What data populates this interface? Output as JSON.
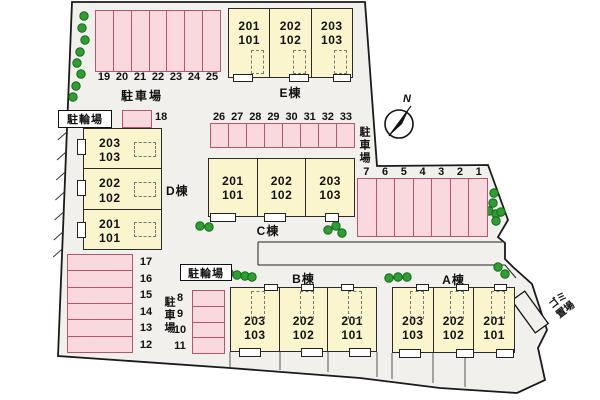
{
  "labels": {
    "parking_lot": "駐車場",
    "bicycle_parking": "駐輪場",
    "garbage": {
      "line1": "ゴミ",
      "line2": "置場"
    }
  },
  "compass": {
    "label": "N"
  },
  "parking": {
    "top_left": {
      "label": "駐車場",
      "spaces": [
        "19",
        "20",
        "21",
        "22",
        "23",
        "24",
        "25"
      ]
    },
    "middle": {
      "label": "駐車場",
      "spaces": [
        "26",
        "27",
        "28",
        "29",
        "30",
        "31",
        "32",
        "33"
      ]
    },
    "right": {
      "spaces": [
        "7",
        "6",
        "5",
        "4",
        "3",
        "2",
        "1"
      ]
    },
    "bottom_left": {
      "label": "駐車場",
      "spaces": [
        "17",
        "16",
        "15",
        "14",
        "13",
        "12"
      ]
    },
    "space_18": {
      "number": "18"
    },
    "bicycle_1": {
      "label": "駐輪場"
    },
    "bicycle_2": {
      "label": "駐輪場",
      "spaces": [
        "8",
        "9",
        "10",
        "11"
      ]
    }
  },
  "buildings": {
    "e": {
      "name": "E棟",
      "units": [
        {
          "upper": "201",
          "lower": "101"
        },
        {
          "upper": "202",
          "lower": "102"
        },
        {
          "upper": "203",
          "lower": "103"
        }
      ]
    },
    "d": {
      "name": "D棟",
      "units": [
        {
          "upper": "203",
          "lower": "103"
        },
        {
          "upper": "202",
          "lower": "102"
        },
        {
          "upper": "201",
          "lower": "101"
        }
      ]
    },
    "c": {
      "name": "C棟",
      "units": [
        {
          "upper": "201",
          "lower": "101"
        },
        {
          "upper": "202",
          "lower": "102"
        },
        {
          "upper": "203",
          "lower": "103"
        }
      ]
    },
    "b": {
      "name": "B棟",
      "units": [
        {
          "upper": "203",
          "lower": "103"
        },
        {
          "upper": "202",
          "lower": "102"
        },
        {
          "upper": "201",
          "lower": "101"
        }
      ]
    },
    "a": {
      "name": "A棟",
      "units": [
        {
          "upper": "203",
          "lower": "103"
        },
        {
          "upper": "202",
          "lower": "102"
        },
        {
          "upper": "201",
          "lower": "101"
        }
      ]
    }
  },
  "colors": {
    "site_fill": "#f1f0ec",
    "parking_fill": "#f9d8de",
    "parking_border": "#b4566e",
    "building_fill": "#faf5cc",
    "tree_green": "#2f9e33"
  }
}
